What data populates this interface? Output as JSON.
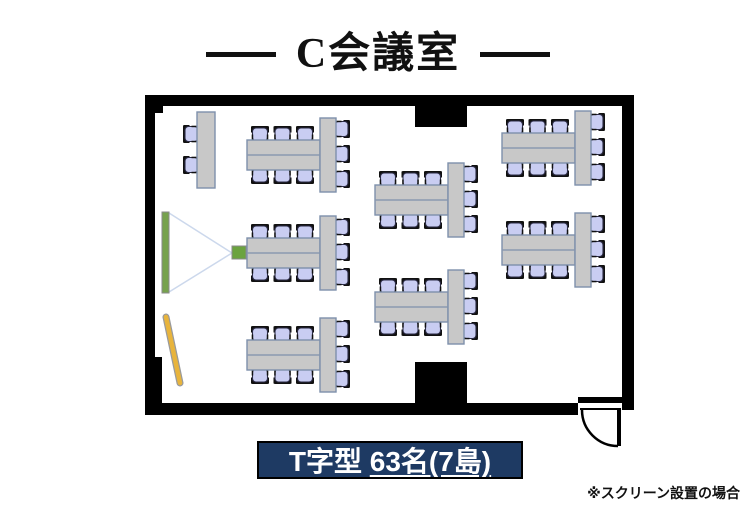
{
  "title": {
    "text": "C会議室"
  },
  "capacity_label": {
    "layout": "T字型 ",
    "detail": "63名(7島)"
  },
  "footnote": "※スクリーン設置の場合",
  "floor_plan": {
    "islands_count": 7,
    "seats_per_island": 9,
    "total_seats": 63,
    "side_table_seats": 2,
    "islands": [
      {
        "id": "left-top",
        "x": 102,
        "y": 23
      },
      {
        "id": "left-middle",
        "x": 102,
        "y": 121
      },
      {
        "id": "left-bottom",
        "x": 102,
        "y": 223
      },
      {
        "id": "center-top",
        "x": 230,
        "y": 68
      },
      {
        "id": "center-bottom",
        "x": 230,
        "y": 175
      },
      {
        "id": "right-top",
        "x": 357,
        "y": 16
      },
      {
        "id": "right-middle",
        "x": 357,
        "y": 118
      }
    ]
  },
  "colors": {
    "wall": "#000000",
    "floor": "#ffffff",
    "table_fill": "#c8c8c8",
    "table_border": "#7e90ab",
    "chair_fill": "#c9cdf2",
    "chair_border": "#2b2b45",
    "chair_back": "#111111",
    "screen": "#77a24d",
    "projector": "#6ba33f",
    "whiteboard": "#e8b43c",
    "beam": "#ccd8ec",
    "label_bg": "#1e3a63",
    "label_text": "#ffffff"
  }
}
